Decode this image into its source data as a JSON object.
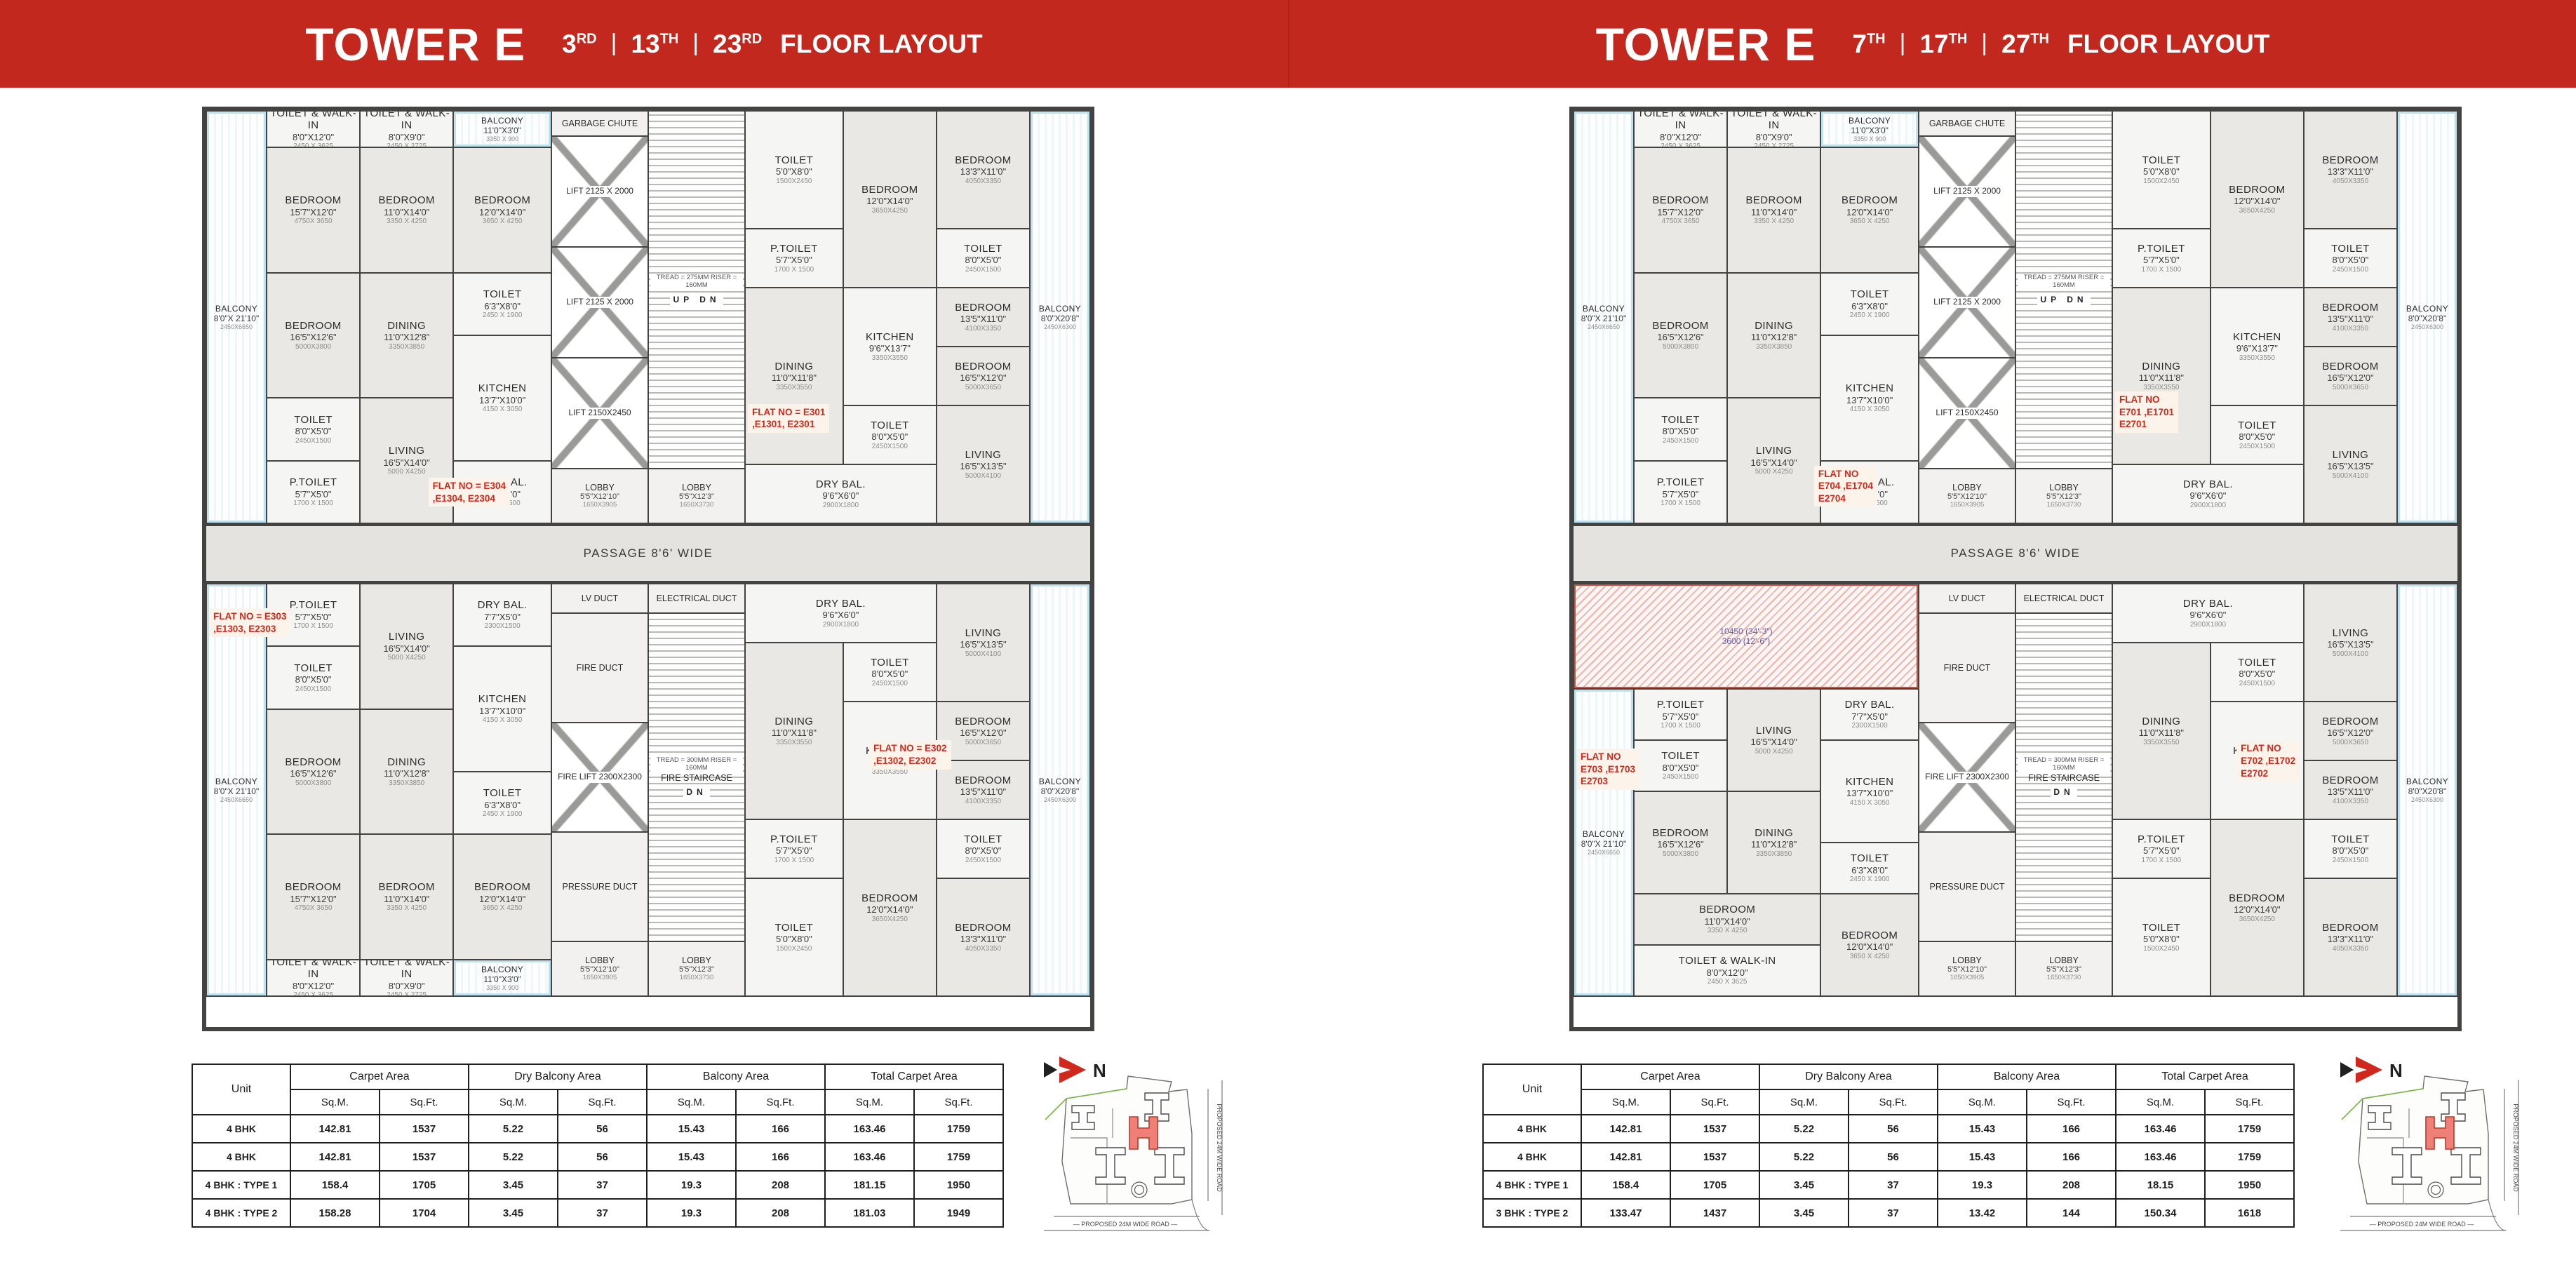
{
  "page": {
    "header_red": "#c3281e",
    "wall_color": "#434341",
    "flat_no_red": "#d3291b"
  },
  "rooms": {
    "balc": {
      "n": "BALCONY",
      "d": "8'0\"X 21'10\"",
      "m": "2450X6650"
    },
    "twk1": {
      "n": "TOILET & WALK-IN",
      "d": "8'0\"X12'0\"",
      "m": "2450 X 3625"
    },
    "twk2": {
      "n": "TOILET & WALK-IN",
      "d": "8'0\"X9'0\"",
      "m": "2450 X 2725"
    },
    "balT": {
      "n": "BALCONY",
      "d": "11'0\"X3'0\"",
      "m": "3350 X 900"
    },
    "bedA": {
      "n": "BEDROOM",
      "d": "11'0\"X14'0\"",
      "m": "3350 X 4250"
    },
    "bedD12": {
      "n": "BEDROOM",
      "d": "12'0\"X14'0\"",
      "m": "3650 X 4250"
    },
    "bedB": {
      "n": "BEDROOM",
      "d": "15'7\"X12'0\"",
      "m": "4750X 3650"
    },
    "bedC": {
      "n": "BEDROOM",
      "d": "16'5\"X12'6\"",
      "m": "5000X3800"
    },
    "din": {
      "n": "DINING",
      "d": "11'0\"X12'8\"",
      "m": "3350X3850"
    },
    "toiB": {
      "n": "TOILET",
      "d": "6'3\"X8'0\"",
      "m": "2450 X 1900"
    },
    "toiA": {
      "n": "TOILET",
      "d": "8'0\"X5'0\"",
      "m": "2450X1500"
    },
    "liv": {
      "n": "LIVING",
      "d": "16'5\"X14'0\"",
      "m": "5000 X4250"
    },
    "kit": {
      "n": "KITCHEN",
      "d": "13'7\"X10'0\"",
      "m": "4150 X 3050"
    },
    "pt": {
      "n": "P.TOILET",
      "d": "5'7\"X5'0\"",
      "m": "1700 X 1500"
    },
    "dry": {
      "n": "DRY BAL.",
      "d": "7'7\"X5'0\"",
      "m": "2300X1500"
    },
    "toiC": {
      "n": "TOILET",
      "d": "5'0\"X8'0\"",
      "m": "1500X2450"
    },
    "bedD": {
      "n": "BEDROOM",
      "d": "12'0\"X14'0\"",
      "m": "3650X4250"
    },
    "bedE": {
      "n": "BEDROOM",
      "d": "13'3\"X11'0\"",
      "m": "4050X3350"
    },
    "pt2": {
      "n": "P.TOILET",
      "d": "5'7\"X5'0\"",
      "m": "1700 X 1500"
    },
    "toi4": {
      "n": "TOILET",
      "d": "8'0\"X5'0\"",
      "m": "2450X1500"
    },
    "toi5": {
      "n": "TOILET",
      "d": "8'0\"X5'0\"",
      "m": "2450X1500"
    },
    "din2": {
      "n": "DINING",
      "d": "11'0\"X11'8\"",
      "m": "3350X3550"
    },
    "kit2": {
      "n": "KITCHEN",
      "d": "9'6\"X13'7\"",
      "m": "3350X3550"
    },
    "bedF": {
      "n": "BEDROOM",
      "d": "13'5\"X11'0\"",
      "m": "4100X3350"
    },
    "bedG": {
      "n": "BEDROOM",
      "d": "16'5\"X12'0\"",
      "m": "5000X3650"
    },
    "liv2": {
      "n": "LIVING",
      "d": "16'5\"X13'5\"",
      "m": "5000X4100"
    },
    "dry2": {
      "n": "DRY BAL.",
      "d": "9'6\"X6'0\"",
      "m": "2900X1800"
    },
    "balcR": {
      "n": "BALCONY",
      "d": "8'0\"X20'8\"",
      "m": "2450X6300"
    },
    "ref": {
      "n": "",
      "d": "10450 (34'-3\")",
      "m": "3600 (12'-6\")"
    }
  },
  "core": {
    "garbage": "GARBAGE CHUTE",
    "lifts": [
      "LIFT 2125 X 2000",
      "LIFT 2125 X 2000",
      "LIFT 2150X2450"
    ],
    "stair_note": "TREAD = 275MM RISER = 160MM",
    "up": "UP",
    "dn": "DN",
    "lobby_l": {
      "n": "LOBBY",
      "d": "5'5\"X12'10\"",
      "m": "1650X3905"
    },
    "lobby_r": {
      "n": "LOBBY",
      "d": "5'5\"X12'3\"",
      "m": "1650X3730"
    },
    "passage": "PASSAGE 8'6' WIDE",
    "lv": "LV DUCT",
    "elec": "ELECTRICAL DUCT",
    "fire_duct": "FIRE DUCT",
    "fire_lift": "FIRE LIFT 2300X2300",
    "pressure": "PRESSURE DUCT",
    "fire_stair": "FIRE STAIRCASE",
    "fire_stair_note": "TREAD = 300MM RISER = 160MM"
  },
  "table_head": {
    "unit": "Unit",
    "groups": [
      "Carpet Area",
      "Dry Balcony Area",
      "Balcony Area",
      "Total Carpet Area"
    ],
    "subs": [
      "Sq.M.",
      "Sq.Ft."
    ]
  },
  "keyplan": {
    "north": "N",
    "road_bottom": "PROPOSED 24M WIDE ROAD",
    "road_right": "PROPOSED 24M WIDE ROAD"
  },
  "panels": [
    {
      "header": {
        "title": "TOWER E",
        "floors": [
          [
            "3",
            "RD"
          ],
          [
            "13",
            "TH"
          ],
          [
            "23",
            "RD"
          ]
        ],
        "sep": "|",
        "suffix": "FLOOR LAYOUT"
      },
      "flats": {
        "tl": {
          "no": [
            "FLAT NO = E304",
            ",E1304, E2304"
          ],
          "grid": "tl"
        },
        "tr": {
          "no": [
            "FLAT NO = E301",
            ",E1301, E2301"
          ],
          "grid": "tr"
        },
        "bl": {
          "no": [
            "FLAT NO = E303",
            ",E1303, E2303"
          ],
          "grid": "bl"
        },
        "br": {
          "no": [
            "FLAT NO = E302",
            ",E1302, E2302"
          ],
          "grid": "br"
        }
      },
      "table": {
        "rows": [
          {
            "unit": "4 BHK",
            "values": [
              "142.81",
              "1537",
              "5.22",
              "56",
              "15.43",
              "166",
              "163.46",
              "1759"
            ]
          },
          {
            "unit": "4 BHK",
            "values": [
              "142.81",
              "1537",
              "5.22",
              "56",
              "15.43",
              "166",
              "163.46",
              "1759"
            ]
          },
          {
            "unit": "4 BHK : TYPE 1",
            "values": [
              "158.4",
              "1705",
              "3.45",
              "37",
              "19.3",
              "208",
              "181.15",
              "1950"
            ]
          },
          {
            "unit": "4 BHK : TYPE 2",
            "values": [
              "158.28",
              "1704",
              "3.45",
              "37",
              "19.3",
              "208",
              "181.03",
              "1949"
            ]
          }
        ]
      }
    },
    {
      "header": {
        "title": "TOWER E",
        "floors": [
          [
            "7",
            "TH"
          ],
          [
            "17",
            "TH"
          ],
          [
            "27",
            "TH"
          ]
        ],
        "sep": "|",
        "suffix": "FLOOR LAYOUT"
      },
      "flats": {
        "tl": {
          "no": [
            "FLAT NO",
            "E704 ,E1704",
            "E2704"
          ],
          "grid": "tl"
        },
        "tr": {
          "no": [
            "FLAT NO",
            "E701 ,E1701",
            "E2701"
          ],
          "grid": "tr"
        },
        "bl": {
          "no": [
            "FLAT NO",
            "E703 ,E1703",
            "E2703"
          ],
          "grid": "bl3"
        },
        "br": {
          "no": [
            "FLAT NO",
            "E702 ,E1702",
            "E2702"
          ],
          "grid": "br"
        }
      },
      "table": {
        "rows": [
          {
            "unit": "4 BHK",
            "values": [
              "142.81",
              "1537",
              "5.22",
              "56",
              "15.43",
              "166",
              "163.46",
              "1759"
            ]
          },
          {
            "unit": "4 BHK",
            "values": [
              "142.81",
              "1537",
              "5.22",
              "56",
              "15.43",
              "166",
              "163.46",
              "1759"
            ]
          },
          {
            "unit": "4 BHK : TYPE 1",
            "values": [
              "158.4",
              "1705",
              "3.45",
              "37",
              "19.3",
              "208",
              "18.15",
              "1950"
            ]
          },
          {
            "unit": "3 BHK : TYPE 2",
            "values": [
              "133.47",
              "1437",
              "3.45",
              "37",
              "13.42",
              "144",
              "150.34",
              "1618"
            ]
          }
        ]
      }
    }
  ]
}
